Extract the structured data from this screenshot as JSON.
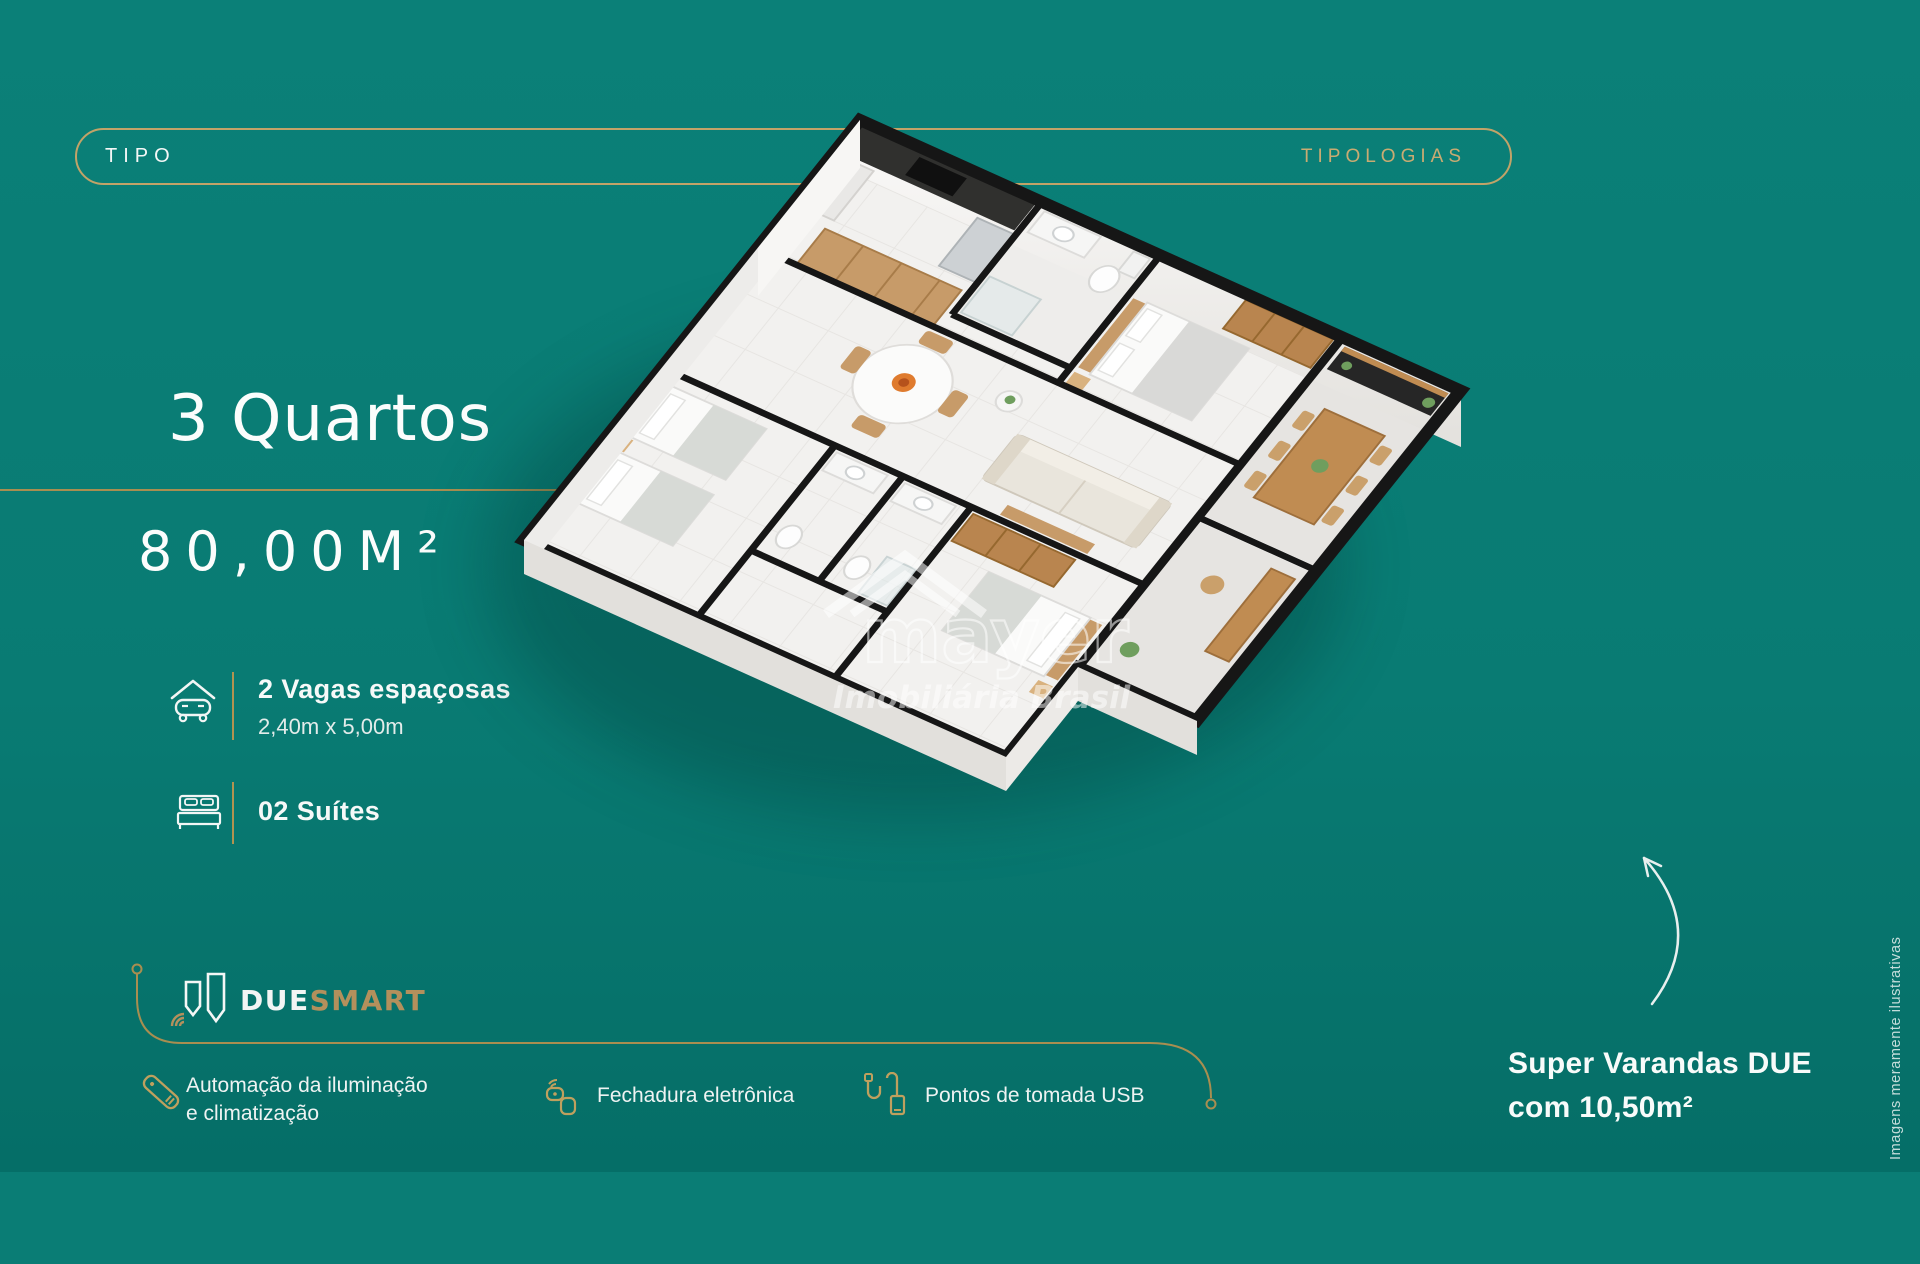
{
  "header": {
    "tipo": "TIPO",
    "tipologias": "TIPOLOGIAS"
  },
  "unit": {
    "title": "3 Quartos",
    "area": "80,00M²"
  },
  "features": {
    "parking": {
      "icon": "garage-car-icon",
      "title": "2 Vagas espaçosas",
      "subtitle": "2,40m x 5,00m"
    },
    "suites": {
      "icon": "double-bed-icon",
      "label": "02 Suítes"
    }
  },
  "smart": {
    "brand_due": "DUE",
    "brand_smart": "SMART",
    "items": [
      {
        "icon": "remote-control-icon",
        "line1": "Automação da iluminação",
        "line2": "e climatização"
      },
      {
        "icon": "smart-lock-icon",
        "label": "Fechadura eletrônica"
      },
      {
        "icon": "usb-cable-icon",
        "label": "Pontos de tomada USB"
      }
    ]
  },
  "callout": {
    "line1": "Super Varandas DUE",
    "line2": "com 10,50m²"
  },
  "disclaimer": "Imagens meramente ilustrativas",
  "watermark": {
    "name": "mayer",
    "subtitle": "Imobiliária Brasil"
  },
  "colors": {
    "background": "#097b73",
    "gold": "#c2a368",
    "gold_line": "#a98e50",
    "white": "#fbfdfc"
  }
}
